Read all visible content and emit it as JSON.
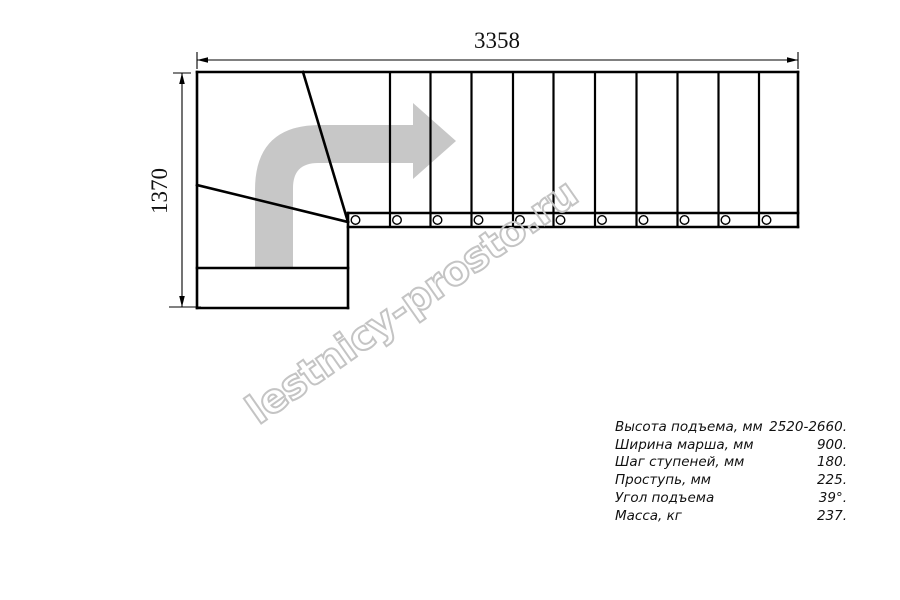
{
  "dimensions": {
    "width_mm": "3358",
    "height_mm": "1370"
  },
  "watermark": {
    "text": "lestnicy-prosto.ru",
    "color": "#c4c4c4"
  },
  "diagram": {
    "type": "staircase-plan-top-view",
    "straight_treads": 11,
    "winder_treads": 2,
    "bottom_platform_steps": 1,
    "baluster_circles": 11,
    "direction_arrow": "up-then-right",
    "arrow_fill": "#c7c7c7",
    "line_color": "#000000"
  },
  "specs": {
    "rows": [
      {
        "label": "Высота подъема, мм",
        "value": "2520-2660."
      },
      {
        "label": "Ширина марша, мм",
        "value": "900."
      },
      {
        "label": "Шаг ступеней, мм",
        "value": "180."
      },
      {
        "label": "Проступь, мм",
        "value": "225."
      },
      {
        "label": "Угол подъема",
        "value": "39°."
      },
      {
        "label": "Масса, кг",
        "value": "237."
      }
    ]
  }
}
